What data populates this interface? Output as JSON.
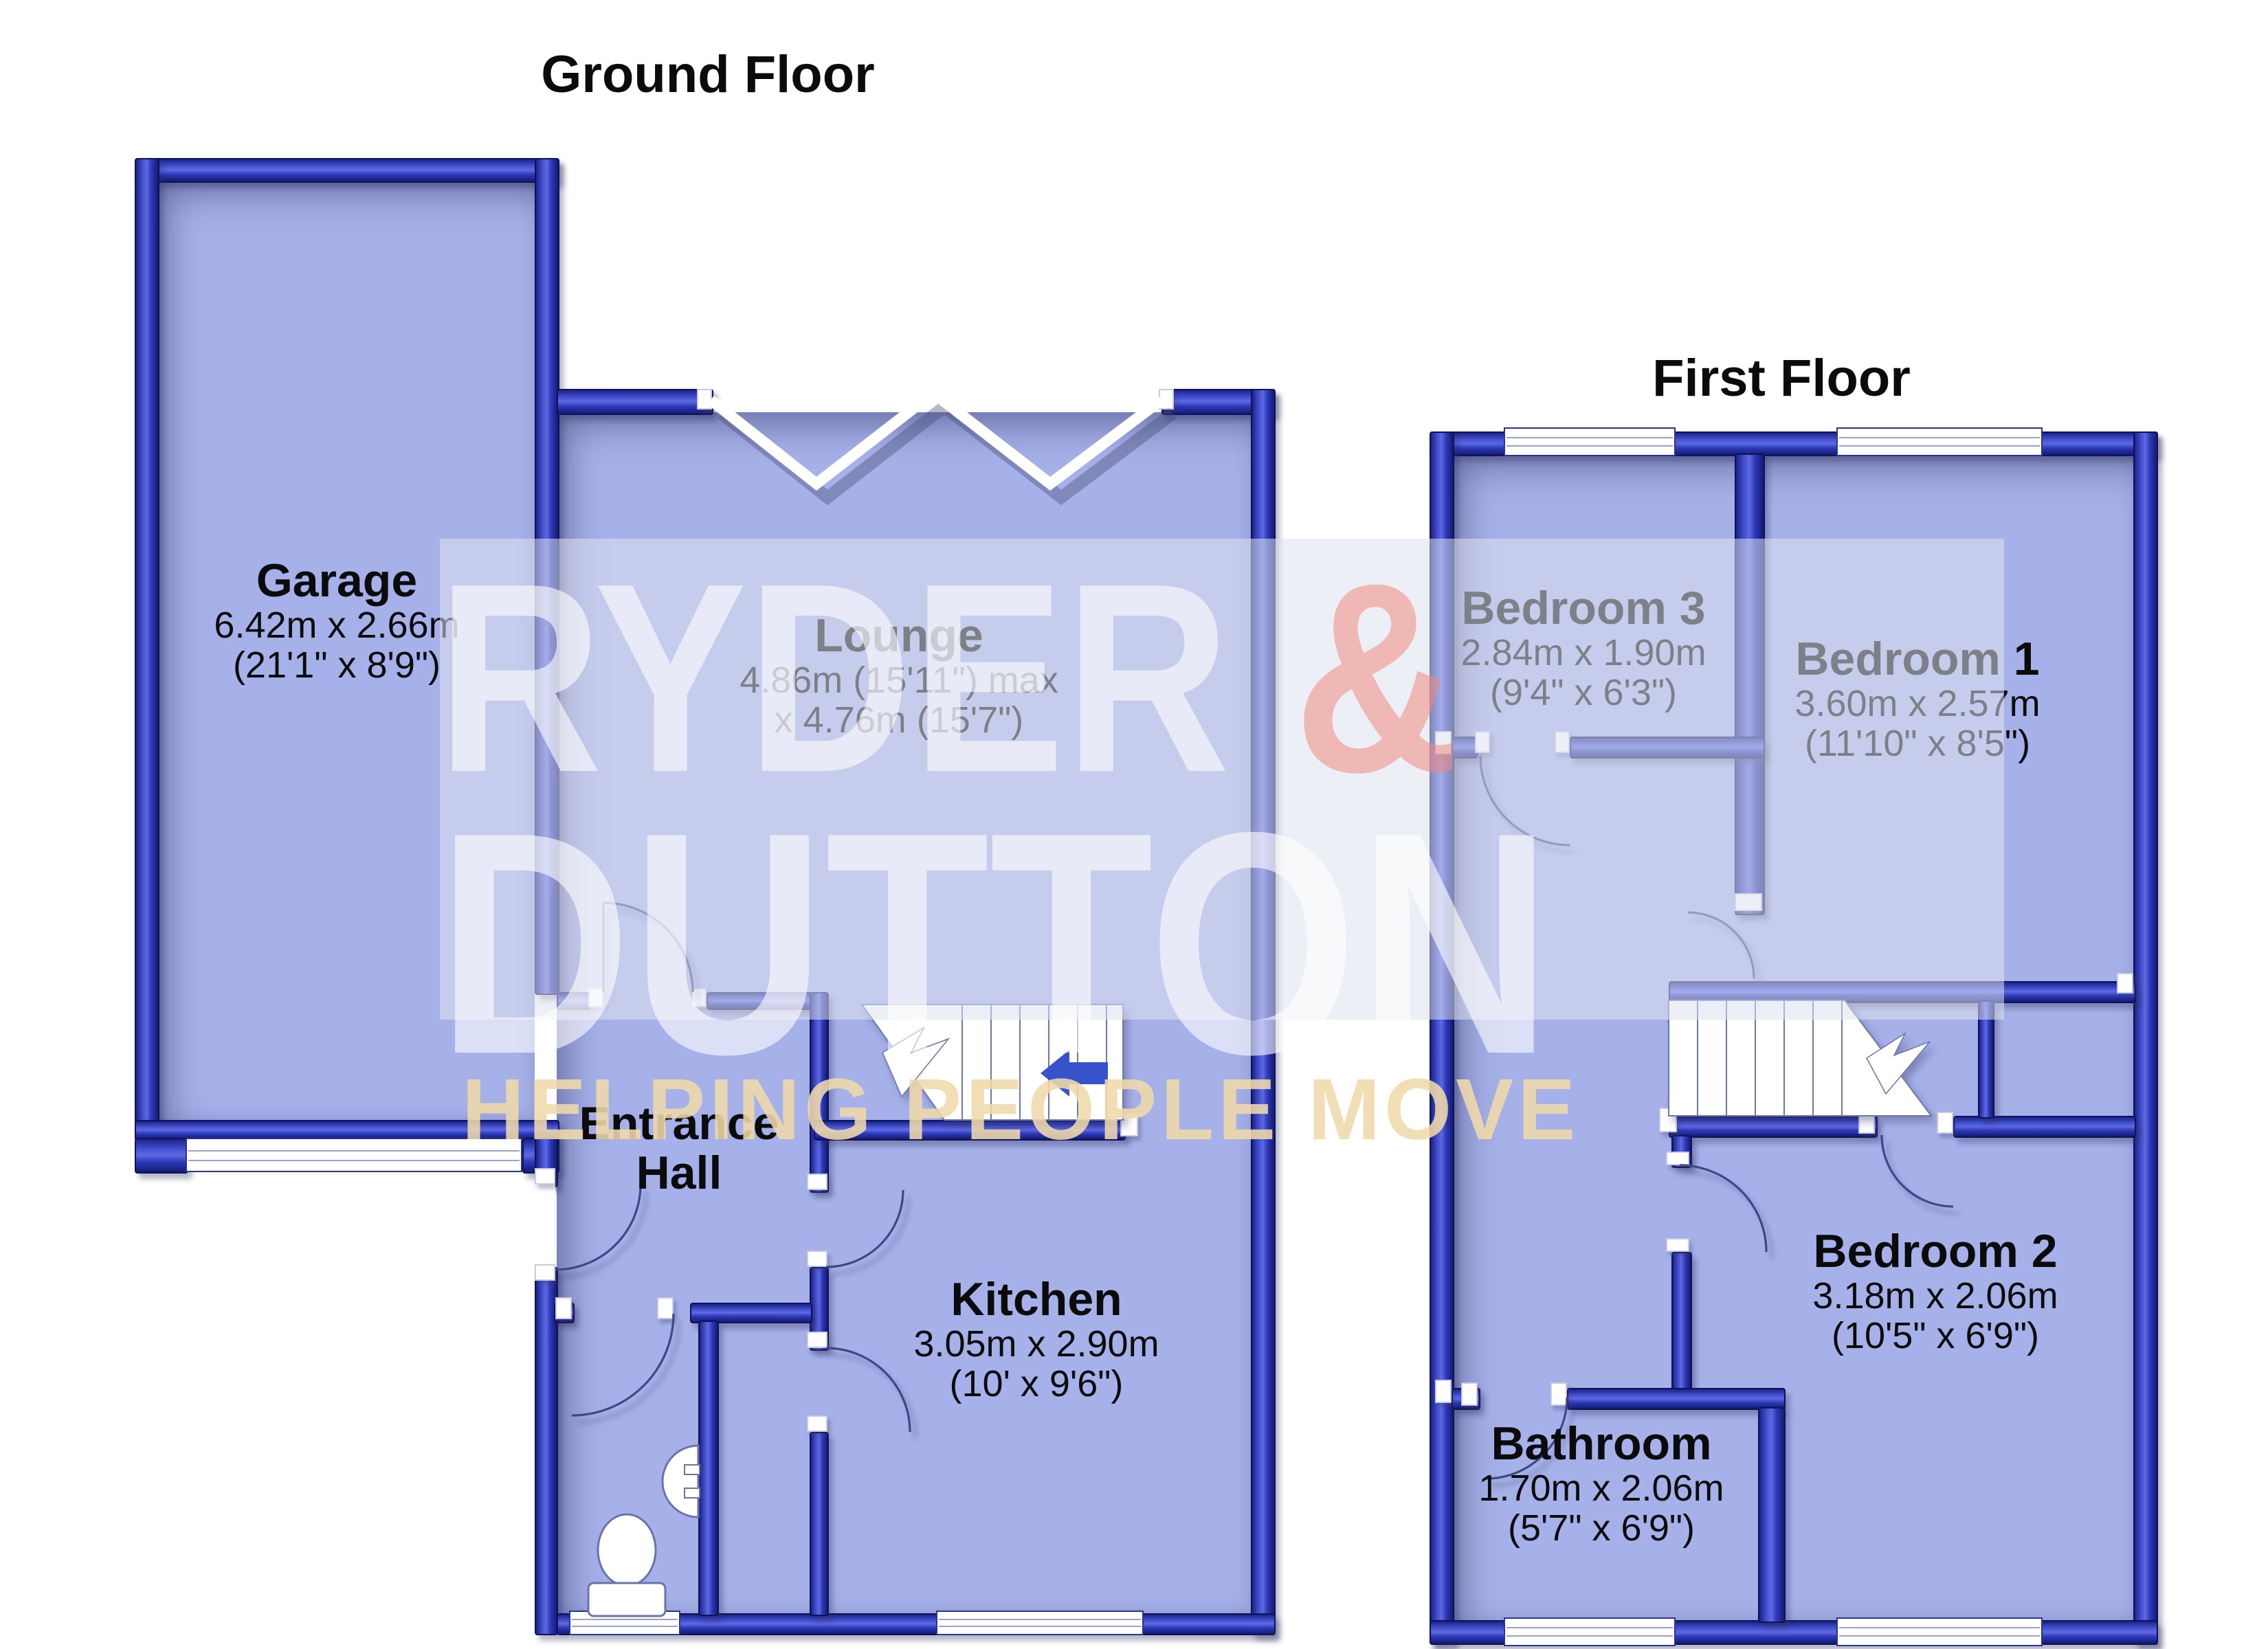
{
  "watermark": {
    "line1": "RYDER",
    "amp": "&",
    "line2": "DUTTON",
    "tagline": "HELPING PEOPLE MOVE"
  },
  "floors": {
    "ground": {
      "title": "Ground Floor",
      "rooms": [
        {
          "id": "garage",
          "name": "Garage",
          "dim_metric": "6.42m x 2.66m",
          "dim_imperial": "(21'1\" x 8'9\")"
        },
        {
          "id": "lounge",
          "name": "Lounge",
          "dim_metric": "4.86m (15'11\") max",
          "dim_imperial": "x 4.76m (15'7\")"
        },
        {
          "id": "entrance-hall",
          "name": "Entrance Hall"
        },
        {
          "id": "kitchen",
          "name": "Kitchen",
          "dim_metric": "3.05m x 2.90m",
          "dim_imperial": "(10' x 9'6\")"
        }
      ]
    },
    "first": {
      "title": "First Floor",
      "rooms": [
        {
          "id": "bedroom-3",
          "name": "Bedroom 3",
          "dim_metric": "2.84m x 1.90m",
          "dim_imperial": "(9'4\" x 6'3\")"
        },
        {
          "id": "bedroom-1",
          "name": "Bedroom 1",
          "dim_metric": "3.60m x 2.57m",
          "dim_imperial": "(11'10\" x 8'5\")"
        },
        {
          "id": "bedroom-2",
          "name": "Bedroom 2",
          "dim_metric": "3.18m x 2.06m",
          "dim_imperial": "(10'5\" x 6'9\")"
        },
        {
          "id": "bathroom",
          "name": "Bathroom",
          "dim_metric": "1.70m x 2.06m",
          "dim_imperial": "(5'7\" x 6'9\")"
        }
      ]
    }
  },
  "colors": {
    "wall": "#2c38b8",
    "wall_dark": "#141b71",
    "floor": "#a7b1e9",
    "background": "#ffffff",
    "stairs_arrow": "#3753cb",
    "watermark_text": "rgba(255,255,255,0.6)",
    "watermark_amp": "#f08b80",
    "watermark_tagline": "#f0d9aa"
  }
}
